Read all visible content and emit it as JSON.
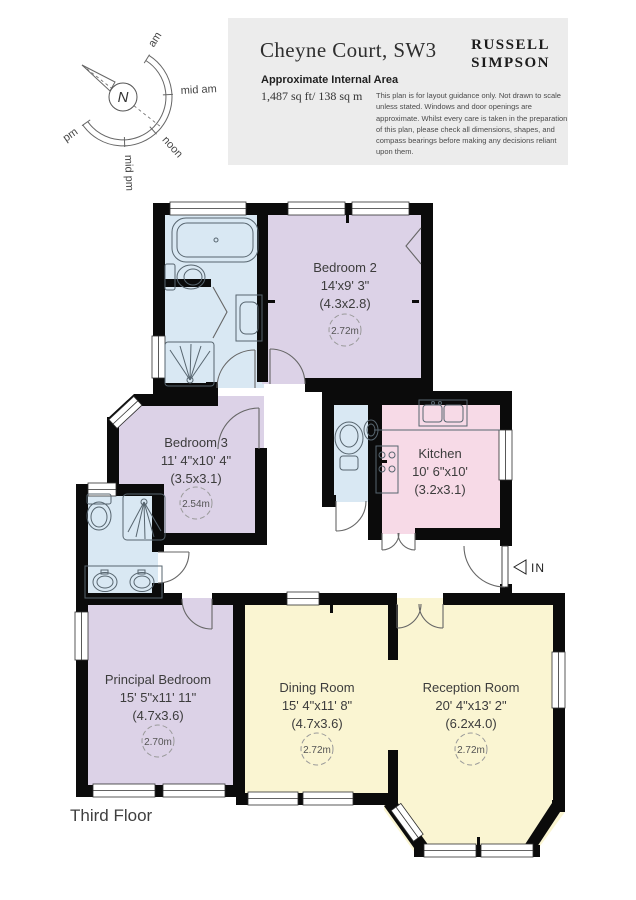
{
  "header": {
    "title": "Cheyne Court, SW3",
    "area_label": "Approximate Internal Area",
    "area_value": "1,487 sq ft/ 138 sq m",
    "logo_line1": "RUSSELL",
    "logo_line2": "SIMPSON",
    "disclaimer": "This plan is for layout guidance only. Not drawn to scale unless stated. Windows and door openings are approximate. Whilst every care is taken in the preparation of this plan, please check all dimensions, shapes, and compass bearings before making any decisions reliant upon them."
  },
  "compass": {
    "north_label": "N",
    "labels": [
      "am",
      "mid am",
      "noon",
      "mid pm",
      "pm"
    ]
  },
  "floor_label": "Third Floor",
  "entrance_label": "IN",
  "rooms": [
    {
      "name": "Bedroom 2",
      "dims_imperial": "14'x9' 3\"",
      "dims_metric": "(4.3x2.8)",
      "ceiling_height": "2.72m"
    },
    {
      "name": "Bedroom 3",
      "dims_imperial": "11' 4\"x10' 4\"",
      "dims_metric": "(3.5x3.1)",
      "ceiling_height": "2.54m"
    },
    {
      "name": "Kitchen",
      "dims_imperial": "10' 6\"x10'",
      "dims_metric": "(3.2x3.1)"
    },
    {
      "name": "Principal Bedroom",
      "dims_imperial": "15' 5\"x11' 11\"",
      "dims_metric": "(4.7x3.6)",
      "ceiling_height": "2.70m"
    },
    {
      "name": "Dining Room",
      "dims_imperial": "15' 4\"x11' 8\"",
      "dims_metric": "(4.7x3.6)",
      "ceiling_height": "2.72m"
    },
    {
      "name": "Reception Room",
      "dims_imperial": "20' 4\"x13' 2\"",
      "dims_metric": "(6.2x4.0)",
      "ceiling_height": "2.72m"
    }
  ],
  "colors": {
    "wall": "#0B0B0B",
    "bedroom_fill": "#DCD2E7",
    "kitchen_fill": "#F7DAE7",
    "reception_fill": "#FAF5D2",
    "bathroom_fill": "#D9E8F3",
    "header_bg": "#ECECEC"
  }
}
